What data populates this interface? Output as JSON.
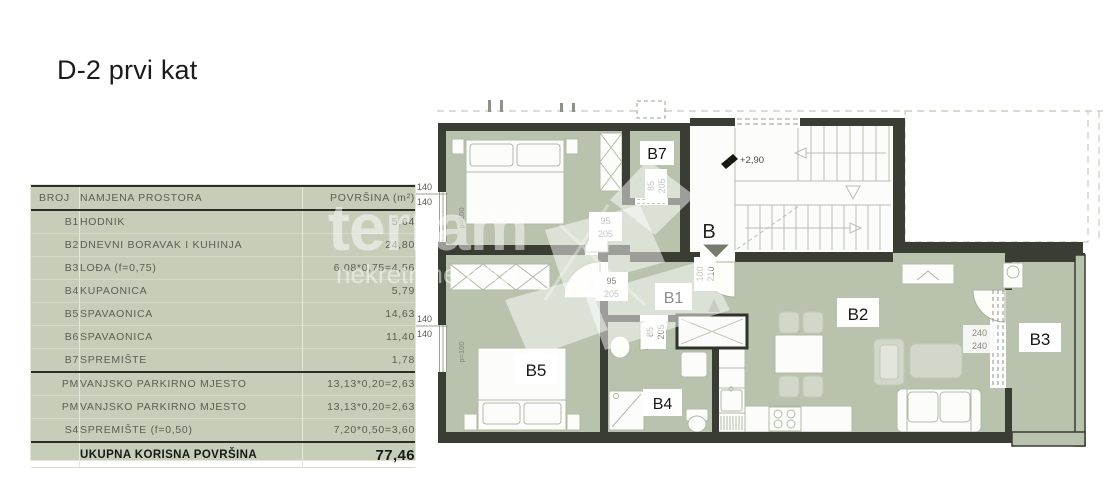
{
  "page": {
    "title": "D-2 prvi kat"
  },
  "table": {
    "headers": [
      "BROJ",
      "NAMJENA PROSTORA",
      "POVRŠINA (m²)"
    ],
    "rows": [
      {
        "id": "B1",
        "name": "HODNIK",
        "area": "5,64"
      },
      {
        "id": "B2",
        "name": "DNEVNI BORAVAK I KUHINJA",
        "area": "24,80"
      },
      {
        "id": "B3",
        "name": "LOĐA (f=0,75)",
        "area": "6,08*0,75=4,56"
      },
      {
        "id": "B4",
        "name": "KUPAONICA",
        "area": "5,79"
      },
      {
        "id": "B5",
        "name": "SPAVAONICA",
        "area": "14,63"
      },
      {
        "id": "B6",
        "name": "SPAVAONICA",
        "area": "11,40"
      },
      {
        "id": "B7",
        "name": "SPREMIŠTE",
        "area": "1,78"
      },
      {
        "id": "PM",
        "name": "VANJSKO PARKIRNO MJESTO",
        "area": "13,13*0,20=2,63"
      },
      {
        "id": "PM",
        "name": "VANJSKO PARKIRNO MJESTO",
        "area": "13,13*0,20=2,63"
      },
      {
        "id": "S4",
        "name": "SPREMIŠTE (f=0,50)",
        "area": "7,20*0,50=3,60"
      }
    ],
    "total_label": "UKUPNA KORISNA POVRŠINA",
    "total_value": "77,46"
  },
  "floorplan": {
    "rooms": {
      "b1": "B1",
      "b2": "B2",
      "b3": "B3",
      "b4": "B4",
      "b5": "B5",
      "b7": "B7"
    },
    "stair_marker": "B",
    "level": "+2,90",
    "dims": {
      "win140_a": "140",
      "win140_b": "140",
      "d95": "95",
      "d95b": "205",
      "d85": "85",
      "d85b": "205",
      "d100": "100",
      "d100b": "210",
      "d240": "240",
      "d240b": "240",
      "parapet": "p=100"
    }
  },
  "watermark": {
    "brand": "terram",
    "tagline": "nekretnine Istra"
  },
  "colors": {
    "plan_green": "#b8c2ac",
    "table_green": "#c6cdb9",
    "wall": "#3a3d34"
  }
}
